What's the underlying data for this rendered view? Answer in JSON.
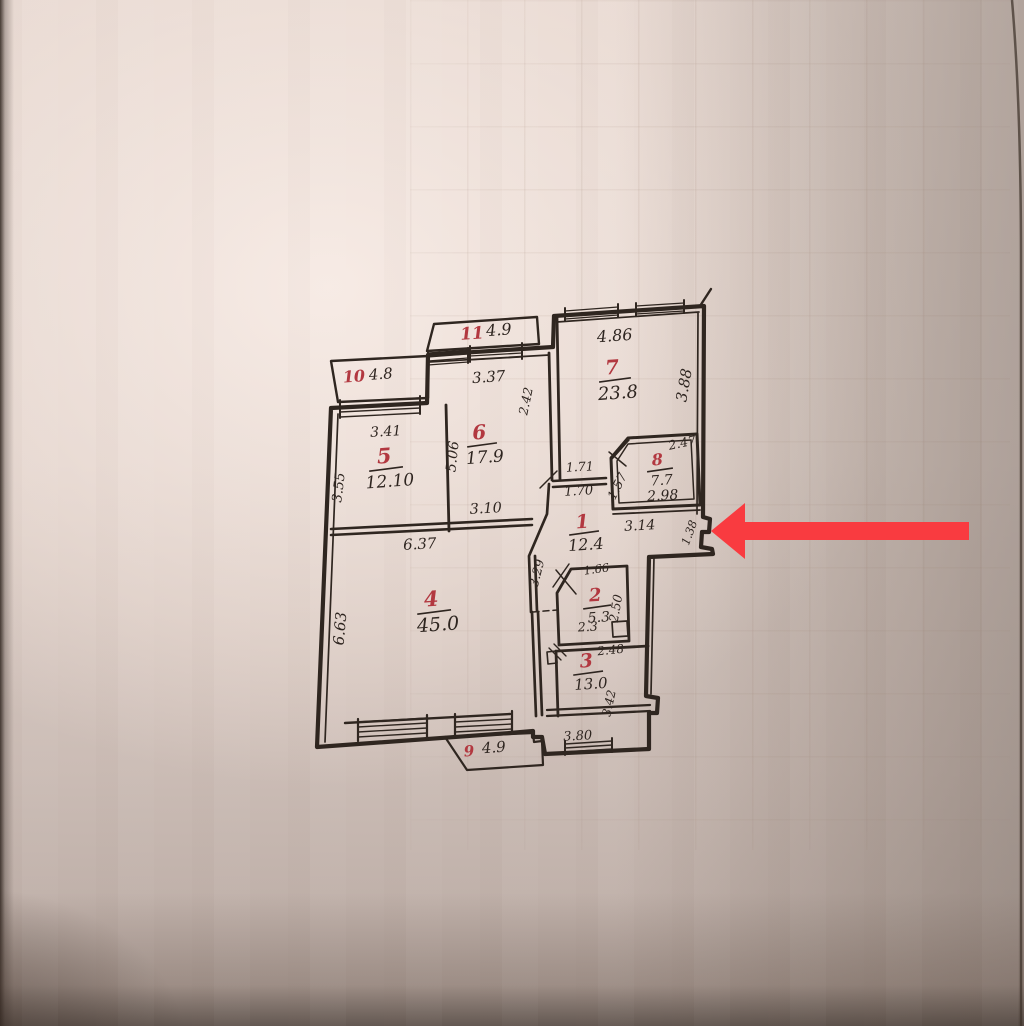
{
  "plan": {
    "rooms": [
      {
        "number": "1",
        "area": "12.4"
      },
      {
        "number": "2",
        "area": "5.3"
      },
      {
        "number": "3",
        "area": "13.0"
      },
      {
        "number": "4",
        "area": "45.0"
      },
      {
        "number": "5",
        "area": "12.10"
      },
      {
        "number": "6",
        "area": "17.9"
      },
      {
        "number": "7",
        "area": "23.8"
      },
      {
        "number": "8",
        "area": "7.7"
      },
      {
        "number": "9",
        "area": "4.9"
      },
      {
        "number": "10",
        "area": "4.8"
      },
      {
        "number": "11",
        "area": "4.9"
      }
    ],
    "dims": {
      "d486": "4.86",
      "d388": "3.88",
      "d337": "3.37",
      "d341": "3.41",
      "d355": "3.55",
      "d506": "5.06",
      "d242": "2.42",
      "d310": "3.10",
      "d637": "6.37",
      "d663": "6.63",
      "d171": "1.71",
      "d170": "1.70",
      "d247": "2.47",
      "d157": "1.57",
      "d298": "2.98",
      "d314": "3.14",
      "d138": "1.38",
      "d329": "3.29",
      "d166": "1.66",
      "d250": "2.50",
      "d23": "2.3",
      "d248": "2.48",
      "d342": "3.42",
      "d380": "3.80"
    }
  },
  "annotation": {
    "arrow_color": "#f93b40",
    "arrow_direction": "left"
  },
  "ink": {
    "wall": "#2f2620",
    "red_label": "#b23840"
  }
}
